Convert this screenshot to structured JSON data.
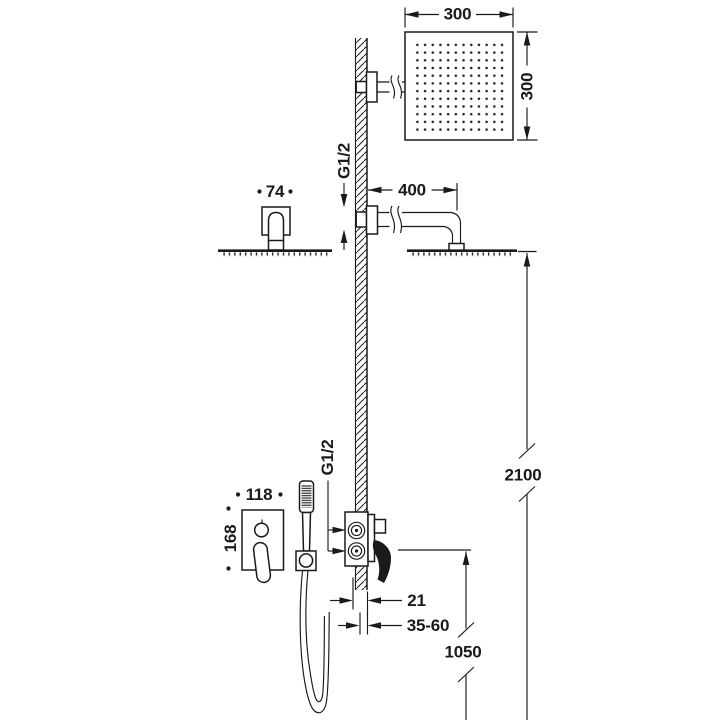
{
  "colors": {
    "ink": "#1a1a1a",
    "paper": "#ffffff"
  },
  "labels": {
    "head_width": "300",
    "head_height": "300",
    "arm_thread": "G1/2",
    "arm_length": "400",
    "escutcheon_width": "74",
    "total_height": "2100",
    "valve_thread": "G1/2",
    "trim_width": "118",
    "trim_height": "168",
    "wall_offset": "21",
    "rough_in_depth": "35-60",
    "valve_height": "1050"
  }
}
